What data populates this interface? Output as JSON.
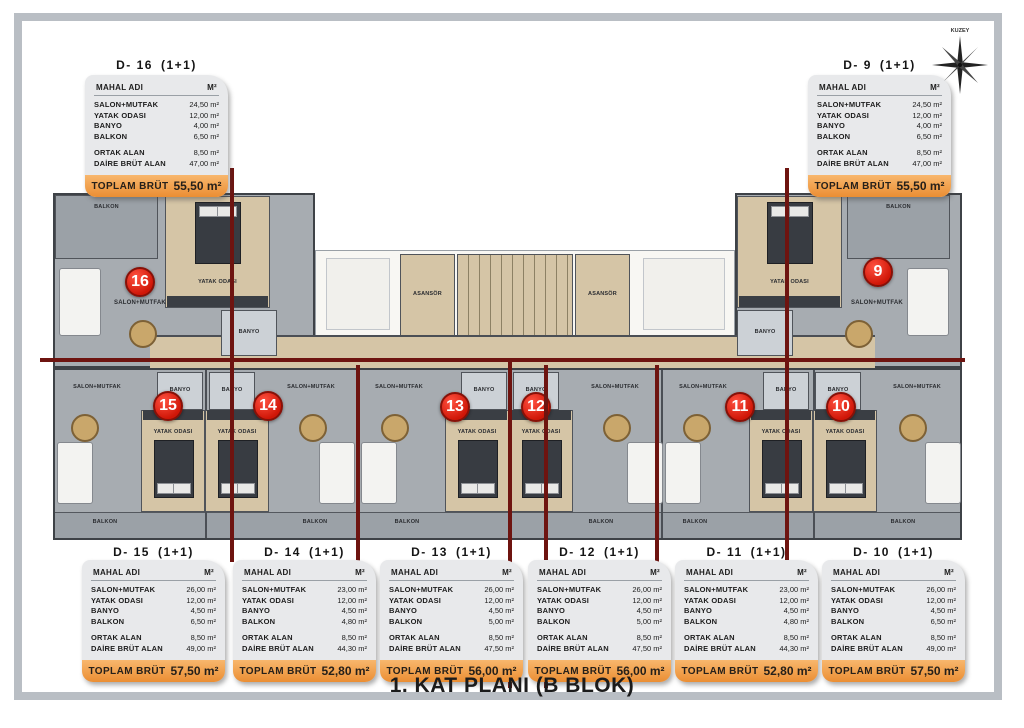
{
  "page": {
    "title": "1. KAT PLANI (B BLOK)",
    "compass_label": "KUZEY"
  },
  "labels": {
    "header_name": "MAHAL ADI",
    "header_unit": "M²",
    "total": "TOPLAM BRÜT",
    "balkon": "BALKON",
    "salon": "SALON+MUTFAK",
    "yatak": "YATAK ODASI",
    "banyo": "BANYO",
    "asansor": "ASANSÖR"
  },
  "circles": [
    "16",
    "9",
    "15",
    "14",
    "13",
    "12",
    "11",
    "10"
  ],
  "units": [
    {
      "id": "D- 16",
      "type": "(1+1)",
      "rows": [
        [
          "SALON+MUTFAK",
          "24,50 m²"
        ],
        [
          "YATAK ODASI",
          "12,00 m²"
        ],
        [
          "BANYO",
          "4,00 m²"
        ],
        [
          "BALKON",
          "6,50 m²"
        ],
        [
          "ORTAK ALAN",
          "8,50 m²"
        ],
        [
          "DAİRE BRÜT ALAN",
          "47,00 m²"
        ]
      ],
      "total": "55,50 m²"
    },
    {
      "id": "D- 9",
      "type": "(1+1)",
      "rows": [
        [
          "SALON+MUTFAK",
          "24,50 m²"
        ],
        [
          "YATAK ODASI",
          "12,00 m²"
        ],
        [
          "BANYO",
          "4,00 m²"
        ],
        [
          "BALKON",
          "6,50 m²"
        ],
        [
          "ORTAK ALAN",
          "8,50 m²"
        ],
        [
          "DAİRE BRÜT ALAN",
          "47,00 m²"
        ]
      ],
      "total": "55,50 m²"
    },
    {
      "id": "D- 15",
      "type": "(1+1)",
      "rows": [
        [
          "SALON+MUTFAK",
          "26,00 m²"
        ],
        [
          "YATAK ODASI",
          "12,00 m²"
        ],
        [
          "BANYO",
          "4,50 m²"
        ],
        [
          "BALKON",
          "6,50 m²"
        ],
        [
          "ORTAK ALAN",
          "8,50 m²"
        ],
        [
          "DAİRE BRÜT ALAN",
          "49,00 m²"
        ]
      ],
      "total": "57,50 m²"
    },
    {
      "id": "D- 14",
      "type": "(1+1)",
      "rows": [
        [
          "SALON+MUTFAK",
          "23,00 m²"
        ],
        [
          "YATAK ODASI",
          "12,00 m²"
        ],
        [
          "BANYO",
          "4,50 m²"
        ],
        [
          "BALKON",
          "4,80 m²"
        ],
        [
          "ORTAK ALAN",
          "8,50 m²"
        ],
        [
          "DAİRE BRÜT ALAN",
          "44,30 m²"
        ]
      ],
      "total": "52,80 m²"
    },
    {
      "id": "D- 13",
      "type": "(1+1)",
      "rows": [
        [
          "SALON+MUTFAK",
          "26,00 m²"
        ],
        [
          "YATAK ODASI",
          "12,00 m²"
        ],
        [
          "BANYO",
          "4,50 m²"
        ],
        [
          "BALKON",
          "5,00 m²"
        ],
        [
          "ORTAK ALAN",
          "8,50 m²"
        ],
        [
          "DAİRE BRÜT ALAN",
          "47,50 m²"
        ]
      ],
      "total": "56,00 m²"
    },
    {
      "id": "D- 12",
      "type": "(1+1)",
      "rows": [
        [
          "SALON+MUTFAK",
          "26,00 m²"
        ],
        [
          "YATAK ODASI",
          "12,00 m²"
        ],
        [
          "BANYO",
          "4,50 m²"
        ],
        [
          "BALKON",
          "5,00 m²"
        ],
        [
          "ORTAK ALAN",
          "8,50 m²"
        ],
        [
          "DAİRE BRÜT ALAN",
          "47,50 m²"
        ]
      ],
      "total": "56,00 m²"
    },
    {
      "id": "D- 11",
      "type": "(1+1)",
      "rows": [
        [
          "SALON+MUTFAK",
          "23,00 m²"
        ],
        [
          "YATAK ODASI",
          "12,00 m²"
        ],
        [
          "BANYO",
          "4,50 m²"
        ],
        [
          "BALKON",
          "4,80 m²"
        ],
        [
          "ORTAK ALAN",
          "8,50 m²"
        ],
        [
          "DAİRE BRÜT ALAN",
          "44,30 m²"
        ]
      ],
      "total": "52,80 m²"
    },
    {
      "id": "D- 10",
      "type": "(1+1)",
      "rows": [
        [
          "SALON+MUTFAK",
          "26,00 m²"
        ],
        [
          "YATAK ODASI",
          "12,00 m²"
        ],
        [
          "BANYO",
          "4,50 m²"
        ],
        [
          "BALKON",
          "6,50 m²"
        ],
        [
          "ORTAK ALAN",
          "8,50 m²"
        ],
        [
          "DAİRE BRÜT ALAN",
          "49,00 m²"
        ]
      ],
      "total": "57,50 m²"
    }
  ],
  "colors": {
    "wall_red": "#6e1410",
    "circle_red": "#cf1607",
    "footer_orange": "#ef9a42",
    "floor_gray": "#a7acb1",
    "floor_tan": "#d5c5a6",
    "frame_gray": "#b9bec4"
  }
}
